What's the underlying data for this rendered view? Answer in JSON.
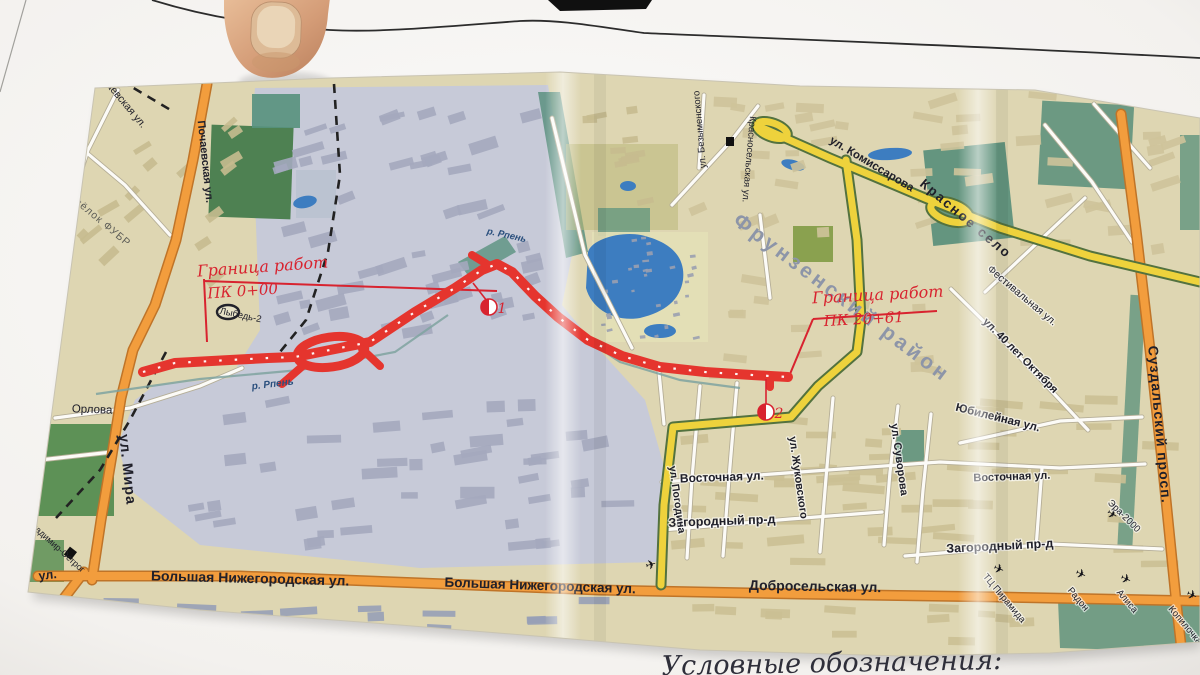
{
  "scene": {
    "legend_caption": "Условные обозначения:"
  },
  "map": {
    "boundary_left": {
      "line1": "Граница работ",
      "line2": "ПК 0+00"
    },
    "boundary_right": {
      "line1": "Граница работ",
      "line2": "ПК 20+61"
    },
    "markers": {
      "m1": "1",
      "m2": "2"
    },
    "labels": {
      "pochaevskaya_diag": "Почаевская ул.",
      "pochaevskaya_vert": "Почаевская ул.",
      "posyolok_fubr": "Посёлок ФУБР",
      "lybed2": "Лыбедь-2",
      "rpen_left": "р. Рпень",
      "rpen_top": "р. Рпень",
      "orlova": "Орлова",
      "ul_mira": "ул. Мира",
      "vladimir_ostrog": "Владимир-Острог",
      "ul_fragment": "ул.",
      "bolshaya_1": "Большая Нижегородская ул.",
      "bolshaya_2": "Большая Нижегородская ул.",
      "dobroselskaya": "Добросельская ул.",
      "tc_piramida": "ТЦ Пирамида",
      "radon": "Радон",
      "alisa": "Алиса",
      "kopilochka": "Копилочка",
      "vostochnaya_1": "Восточная ул.",
      "vostochnaya_2": "Восточная ул.",
      "zagorodny_1": "Загородный пр-д",
      "zagorodny_2": "Загородный пр-д",
      "pogodina": "ул. Погодина",
      "zhukovskogo": "ул. Жуковского",
      "suvorova": "ул. Суворова",
      "yubileynaya": "Юбилейная ул.",
      "let40_oktyabrya": "ул. 40 лет Октября",
      "festivalnaya": "Фестивальная ул.",
      "frunzensky": "Фрунзенский район",
      "krasnoe_selo": "Красное село",
      "komissarova": "ул. Комиссарова",
      "krasnoselskaya": "Красносельская ул.",
      "bezymenskogo": "ул. Безыменского",
      "suzdalsky": "Суздальский просп.",
      "era2000": "Эра-2000"
    },
    "icons": {
      "poi_plane": "✈"
    },
    "colors": {
      "route_red": "#e5352e",
      "boundary_red": "#d8232f",
      "road_orange": "#f29d3d",
      "road_yellow": "#eed23c",
      "water_blue": "#3d7dc0",
      "industrial_gray": "#c7cad8",
      "map_beige": "#ded6b2"
    }
  }
}
